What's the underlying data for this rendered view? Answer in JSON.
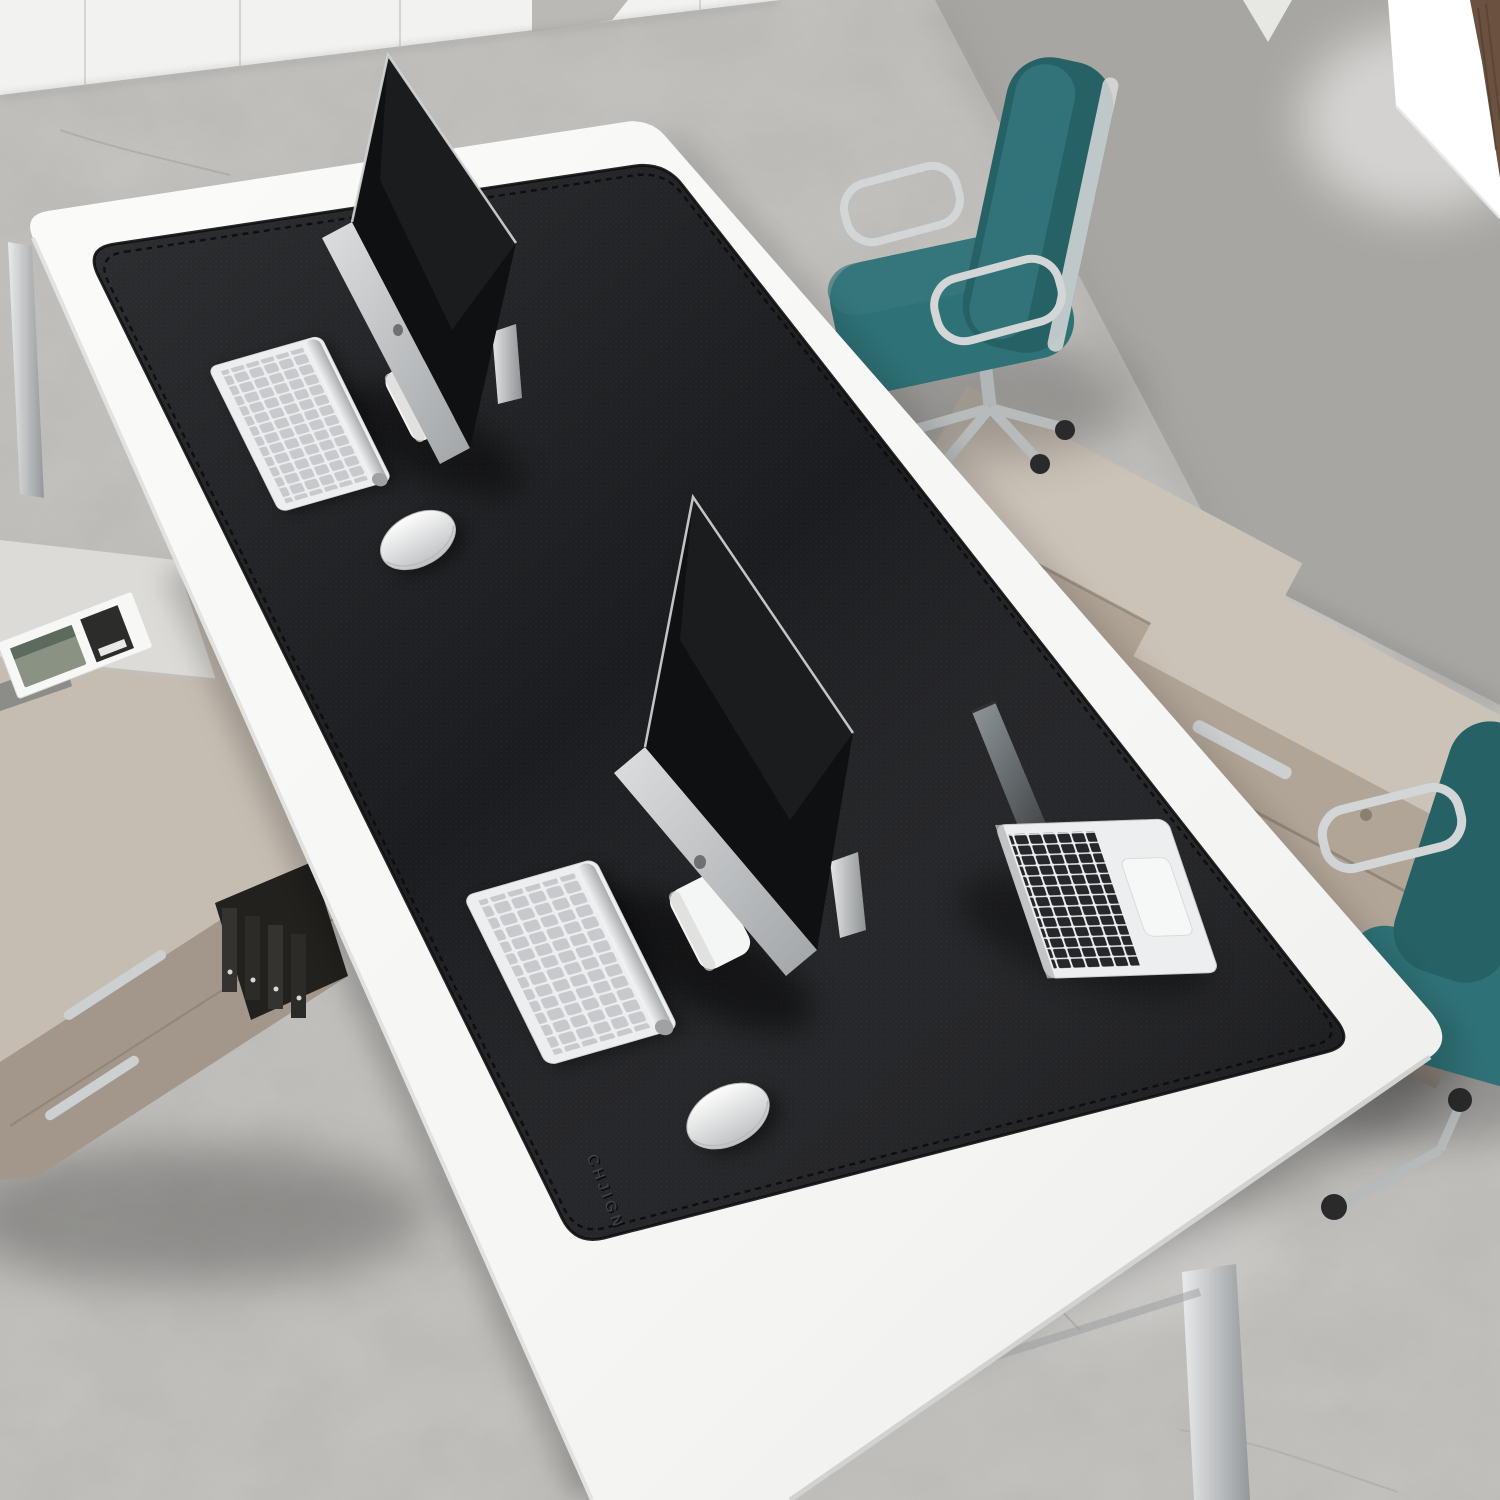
{
  "scene": {
    "description": "Overhead office scene: oversized black leather desk pad on a white conference table with two iMacs, two Apple keyboards, two mice and an open MacBook; teal office chairs, taupe cabinets, white wall cabinets and a concrete floor",
    "mat": {
      "brand": "CHJIGN",
      "color": "#1b1c1f",
      "stitch_color": "#0d0e10"
    },
    "table": {
      "color": "#f6f6f4",
      "leg_color": "#c9cbcc"
    },
    "floor": {
      "color": "#c9c7c3"
    },
    "wall": {
      "color": "#a8a6a2"
    },
    "window": {
      "light_color": "#ffffff",
      "frame_color": "#6b5140"
    },
    "cabinets": {
      "white": "#f2f2f0",
      "taupe_top": "#c6bdb2",
      "taupe_front": "#a2978a",
      "beige_top": "#ccc3b8",
      "beige_front": "#b1a597",
      "handle": "#cdd0d1",
      "binder": "#34332f"
    },
    "chairs": {
      "teal": "#2e7176",
      "teal_dark": "#266166",
      "shell": "#b7babb",
      "chrome": "#d3d6d7"
    },
    "devices": {
      "silver": "#eceeef",
      "key_gray": "#c7c9cc",
      "screen_black": "#0e1012",
      "mac_key_black": "#26272a",
      "white": "#f4f5f5"
    }
  }
}
